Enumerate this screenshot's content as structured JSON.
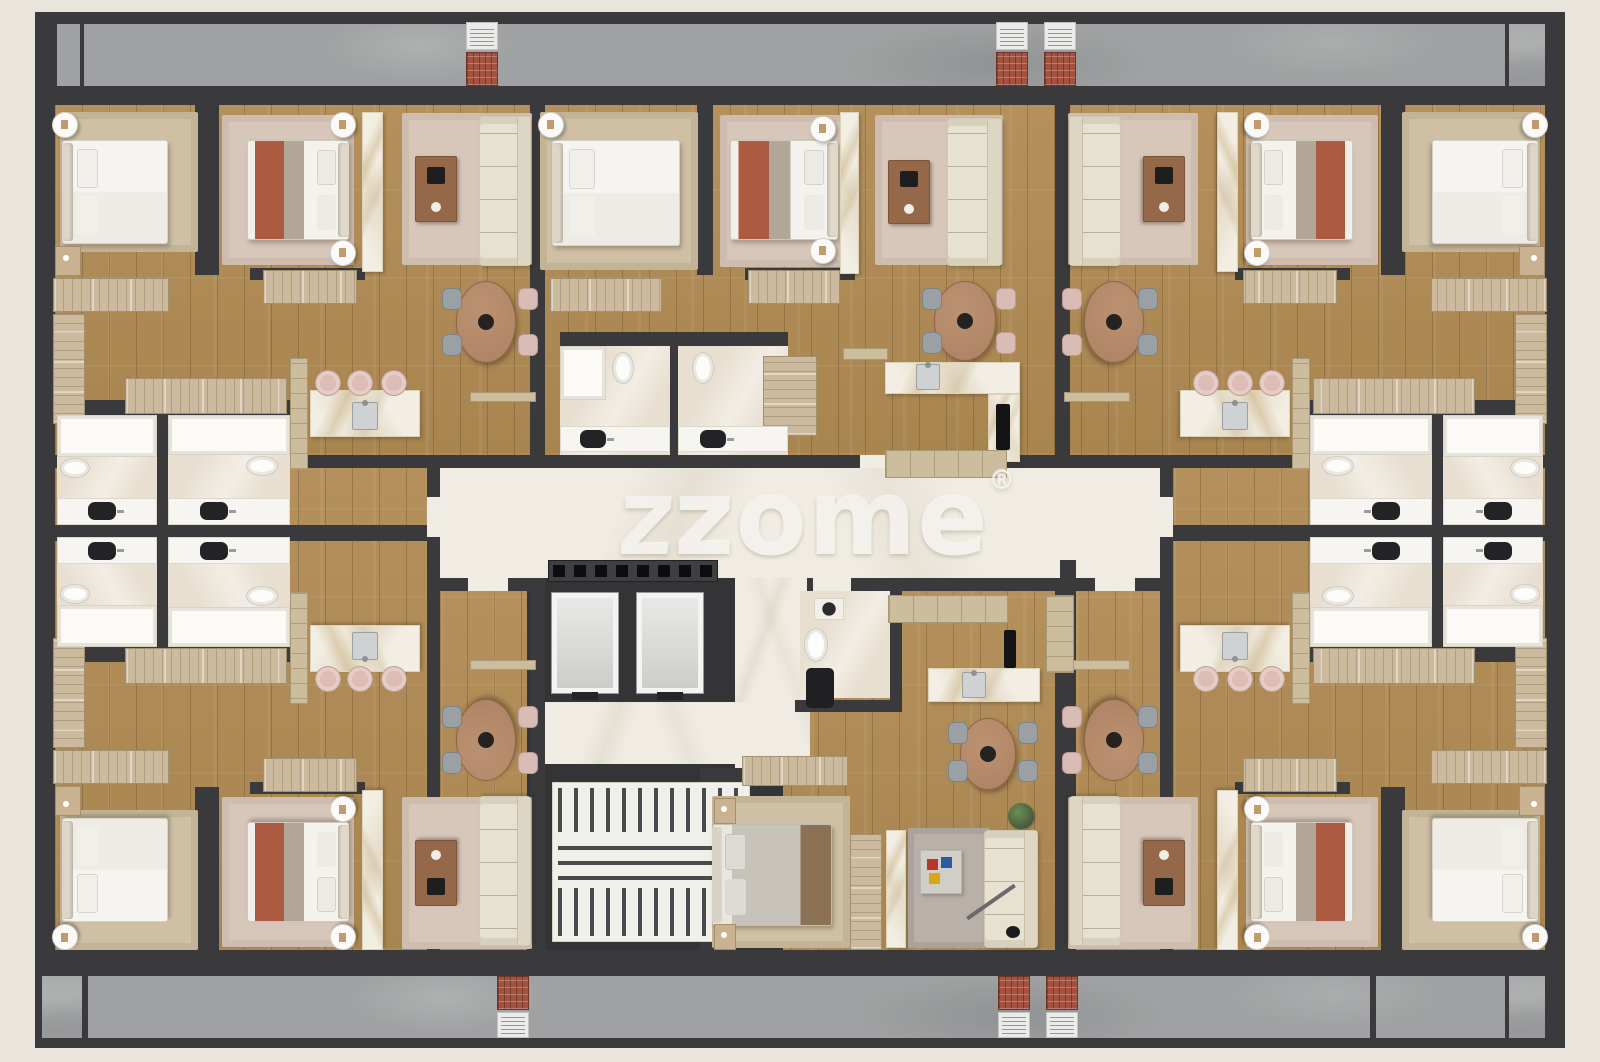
{
  "canvas": {
    "w": 1600,
    "h": 1062,
    "background": "#e9e5dd"
  },
  "watermark": {
    "logo_glyph": "z",
    "text": "zome",
    "registered": "®"
  },
  "palette": {
    "wall": "#3a393b",
    "wood": "#b08c58",
    "corridor_marble": "#f0ece3",
    "balcony_concrete": "#9fa1a2",
    "bathroom": "#e8dfd0",
    "accent_red_bed": "#ac5a42",
    "cabinet_tan": "#cbba9e",
    "sofa_cream": "#e7e1d1",
    "brick_bbq": "#a3523f",
    "watermark_color": "#f4f2ed"
  },
  "geometry": {
    "floors": [
      {
        "t": "base",
        "x": 35,
        "y": 12,
        "w": 1530,
        "h": 1036
      },
      {
        "t": "wood",
        "x": 55,
        "y": 105,
        "w": 1490,
        "h": 350
      },
      {
        "t": "wood",
        "x": 55,
        "y": 468,
        "w": 372,
        "h": 482
      },
      {
        "t": "wood",
        "x": 1173,
        "y": 468,
        "w": 372,
        "h": 482
      },
      {
        "t": "wood",
        "x": 440,
        "y": 590,
        "w": 720,
        "h": 360
      },
      {
        "t": "core",
        "x": 527,
        "y": 558,
        "w": 256,
        "h": 392
      },
      {
        "t": "marble",
        "x": 440,
        "y": 468,
        "w": 720,
        "h": 110
      },
      {
        "t": "marble",
        "x": 735,
        "y": 578,
        "w": 75,
        "h": 192
      },
      {
        "t": "marble",
        "x": 540,
        "y": 702,
        "w": 218,
        "h": 62
      },
      {
        "t": "bath",
        "x": 57,
        "y": 415,
        "w": 100,
        "h": 110,
        "m": "xy"
      },
      {
        "t": "bath",
        "x": 168,
        "y": 415,
        "w": 122,
        "h": 110,
        "m": "xy"
      },
      {
        "t": "bath",
        "x": 560,
        "y": 346,
        "w": 110,
        "h": 109
      },
      {
        "t": "bath",
        "x": 678,
        "y": 346,
        "w": 110,
        "h": 109
      },
      {
        "t": "bath",
        "x": 800,
        "y": 591,
        "w": 90,
        "h": 107
      },
      {
        "t": "concrete",
        "x": 57,
        "y": 24,
        "w": 1448,
        "h": 62
      },
      {
        "t": "concrete",
        "x": 1509,
        "y": 24,
        "w": 36,
        "h": 62
      },
      {
        "t": "concrete",
        "x": 88,
        "y": 976,
        "w": 1417,
        "h": 62
      },
      {
        "t": "concrete",
        "x": 42,
        "y": 976,
        "w": 40,
        "h": 62
      },
      {
        "t": "concrete",
        "x": 1509,
        "y": 976,
        "w": 36,
        "h": 62
      }
    ],
    "walls": [
      {
        "x": 195,
        "y": 105,
        "w": 24,
        "h": 170,
        "m": "xy"
      },
      {
        "x": 250,
        "y": 268,
        "w": 115,
        "h": 12,
        "m": "xy"
      },
      {
        "x": 157,
        "y": 415,
        "w": 11,
        "h": 110,
        "m": "xy"
      },
      {
        "x": 45,
        "y": 400,
        "w": 245,
        "h": 15,
        "m": "xy"
      },
      {
        "x": 530,
        "y": 105,
        "w": 15,
        "h": 350,
        "m": "x"
      },
      {
        "x": 35,
        "y": 525,
        "w": 405,
        "h": 16,
        "m": "x"
      },
      {
        "x": 427,
        "y": 455,
        "w": 13,
        "h": 136,
        "m": "x"
      },
      {
        "x": 427,
        "y": 578,
        "w": 113,
        "h": 13,
        "m": "x"
      },
      {
        "x": 530,
        "y": 578,
        "w": 15,
        "h": 372,
        "m": "x"
      },
      {
        "x": 427,
        "y": 455,
        "w": 746,
        "h": 13
      },
      {
        "x": 807,
        "y": 578,
        "w": 366,
        "h": 13
      },
      {
        "x": 697,
        "y": 105,
        "w": 16,
        "h": 170
      },
      {
        "x": 745,
        "y": 268,
        "w": 110,
        "h": 12
      },
      {
        "x": 560,
        "y": 332,
        "w": 228,
        "h": 14
      },
      {
        "x": 670,
        "y": 346,
        "w": 8,
        "h": 109
      },
      {
        "x": 1060,
        "y": 560,
        "w": 16,
        "h": 390
      },
      {
        "x": 890,
        "y": 585,
        "w": 12,
        "h": 118
      },
      {
        "x": 795,
        "y": 700,
        "w": 107,
        "h": 12
      },
      {
        "x": 700,
        "y": 768,
        "w": 110,
        "h": 16
      },
      {
        "x": 700,
        "y": 782,
        "w": 14,
        "h": 178
      },
      {
        "x": 80,
        "y": 24,
        "w": 4,
        "h": 62
      },
      {
        "x": 1370,
        "y": 976,
        "w": 6,
        "h": 62
      }
    ],
    "doors": [
      {
        "x": 468,
        "y": 578,
        "w": 40,
        "h": 13
      },
      {
        "x": 1095,
        "y": 578,
        "w": 40,
        "h": 13
      },
      {
        "x": 860,
        "y": 455,
        "w": 40,
        "h": 13
      },
      {
        "x": 427,
        "y": 497,
        "w": 13,
        "h": 40
      },
      {
        "x": 1160,
        "y": 497,
        "w": 13,
        "h": 40
      },
      {
        "x": 813,
        "y": 578,
        "w": 38,
        "h": 13
      }
    ]
  },
  "furniture": {
    "quadrant": [
      {
        "t": "rug-beige",
        "x": 60,
        "y": 112,
        "w": 138,
        "h": 140
      },
      {
        "t": "bed-white",
        "x": 62,
        "y": 140,
        "w": 106,
        "h": 104
      },
      {
        "t": "side-table",
        "x": 52,
        "y": 112,
        "w": 26,
        "h": 26
      },
      {
        "t": "nightstand",
        "x": 55,
        "y": 246,
        "w": 26,
        "h": 30
      },
      {
        "t": "rug-pink",
        "x": 222,
        "y": 115,
        "w": 132,
        "h": 150
      },
      {
        "t": "bed-red",
        "x": 247,
        "y": 140,
        "w": 102,
        "h": 100
      },
      {
        "t": "side-table",
        "x": 330,
        "y": 112,
        "w": 26,
        "h": 26
      },
      {
        "t": "side-table",
        "x": 330,
        "y": 240,
        "w": 26,
        "h": 26
      },
      {
        "t": "marble-strip",
        "x": 362,
        "y": 112,
        "w": 21,
        "h": 160
      },
      {
        "t": "rug-pink",
        "x": 402,
        "y": 113,
        "w": 130,
        "h": 152
      },
      {
        "t": "sofa",
        "x": 479,
        "y": 116,
        "w": 52,
        "h": 150
      },
      {
        "t": "coffee-table",
        "x": 415,
        "y": 156,
        "w": 42,
        "h": 66
      },
      {
        "t": "dining-table",
        "x": 456,
        "y": 281,
        "w": 60,
        "h": 82
      },
      {
        "t": "chair-gray",
        "x": 442,
        "y": 288,
        "w": 20,
        "h": 22
      },
      {
        "t": "chair-gray",
        "x": 442,
        "y": 334,
        "w": 20,
        "h": 22
      },
      {
        "t": "chair-pink",
        "x": 518,
        "y": 288,
        "w": 20,
        "h": 22
      },
      {
        "t": "chair-pink",
        "x": 518,
        "y": 334,
        "w": 20,
        "h": 22
      },
      {
        "t": "wardrobe",
        "x": 53,
        "y": 278,
        "w": 116,
        "h": 34
      },
      {
        "t": "wardrobe-v",
        "x": 53,
        "y": 314,
        "w": 32,
        "h": 110
      },
      {
        "t": "wardrobe",
        "x": 125,
        "y": 378,
        "w": 162,
        "h": 36
      },
      {
        "t": "wardrobe",
        "x": 263,
        "y": 270,
        "w": 94,
        "h": 34
      },
      {
        "t": "cab-tan-v",
        "x": 290,
        "y": 358,
        "w": 18,
        "h": 112
      },
      {
        "t": "island",
        "x": 310,
        "y": 390,
        "w": 110,
        "h": 47
      },
      {
        "t": "sink",
        "x": 352,
        "y": 402,
        "w": 26,
        "h": 28
      },
      {
        "t": "stool",
        "x": 315,
        "y": 370,
        "w": 26,
        "h": 26
      },
      {
        "t": "stool",
        "x": 347,
        "y": 370,
        "w": 26,
        "h": 26
      },
      {
        "t": "stool",
        "x": 381,
        "y": 370,
        "w": 26,
        "h": 26
      },
      {
        "t": "shelf-tan",
        "x": 470,
        "y": 392,
        "w": 66,
        "h": 10
      },
      {
        "t": "shower",
        "x": 57,
        "y": 415,
        "w": 100,
        "h": 42
      },
      {
        "t": "shower",
        "x": 168,
        "y": 415,
        "w": 122,
        "h": 40
      },
      {
        "t": "counter",
        "x": 57,
        "y": 498,
        "w": 100,
        "h": 27
      },
      {
        "t": "basin",
        "x": 88,
        "y": 502,
        "w": 28,
        "h": 18
      },
      {
        "t": "counter",
        "x": 168,
        "y": 498,
        "w": 122,
        "h": 27
      },
      {
        "t": "basin",
        "x": 200,
        "y": 502,
        "w": 28,
        "h": 18
      },
      {
        "t": "toilet",
        "x": 60,
        "y": 458,
        "w": 30,
        "h": 20
      },
      {
        "t": "toilet",
        "x": 246,
        "y": 456,
        "w": 32,
        "h": 20
      }
    ],
    "center_top": [
      {
        "t": "rug-beige",
        "x": 540,
        "y": 112,
        "w": 158,
        "h": 158
      },
      {
        "t": "bed-white",
        "x": 552,
        "y": 140,
        "w": 128,
        "h": 106
      },
      {
        "t": "side-table",
        "x": 538,
        "y": 112,
        "w": 26,
        "h": 26
      },
      {
        "t": "rug-pink",
        "x": 720,
        "y": 115,
        "w": 132,
        "h": 152
      },
      {
        "t": "bed-red",
        "x": 730,
        "y": 140,
        "w": 108,
        "h": 100
      },
      {
        "t": "side-table",
        "x": 810,
        "y": 116,
        "w": 26,
        "h": 26
      },
      {
        "t": "side-table",
        "x": 810,
        "y": 238,
        "w": 26,
        "h": 26
      },
      {
        "t": "marble-strip",
        "x": 840,
        "y": 112,
        "w": 19,
        "h": 162
      },
      {
        "t": "rug-pink",
        "x": 875,
        "y": 115,
        "w": 128,
        "h": 150
      },
      {
        "t": "sofa",
        "x": 947,
        "y": 118,
        "w": 55,
        "h": 148
      },
      {
        "t": "coffee-table",
        "x": 888,
        "y": 160,
        "w": 42,
        "h": 64
      },
      {
        "t": "wardrobe",
        "x": 550,
        "y": 278,
        "w": 112,
        "h": 34
      },
      {
        "t": "wardrobe",
        "x": 748,
        "y": 270,
        "w": 92,
        "h": 34
      },
      {
        "t": "wardrobe-v",
        "x": 763,
        "y": 356,
        "w": 54,
        "h": 80
      },
      {
        "t": "shelf-tan",
        "x": 843,
        "y": 348,
        "w": 45,
        "h": 12
      },
      {
        "t": "dining-table",
        "x": 934,
        "y": 281,
        "w": 62,
        "h": 80
      },
      {
        "t": "chair-gray",
        "x": 922,
        "y": 288,
        "w": 20,
        "h": 22
      },
      {
        "t": "chair-gray",
        "x": 922,
        "y": 332,
        "w": 20,
        "h": 22
      },
      {
        "t": "chair-pink",
        "x": 996,
        "y": 288,
        "w": 20,
        "h": 22
      },
      {
        "t": "chair-pink",
        "x": 996,
        "y": 332,
        "w": 20,
        "h": 22
      },
      {
        "t": "island",
        "x": 885,
        "y": 362,
        "w": 135,
        "h": 32
      },
      {
        "t": "sink",
        "x": 916,
        "y": 364,
        "w": 24,
        "h": 26
      },
      {
        "t": "island",
        "x": 988,
        "y": 394,
        "w": 32,
        "h": 68
      },
      {
        "t": "cooktop",
        "x": 996,
        "y": 404,
        "w": 14,
        "h": 46
      },
      {
        "t": "cab-tan",
        "x": 885,
        "y": 450,
        "w": 122,
        "h": 28
      },
      {
        "t": "shower",
        "x": 560,
        "y": 346,
        "w": 46,
        "h": 54
      },
      {
        "t": "toilet-v",
        "x": 612,
        "y": 352,
        "w": 22,
        "h": 32
      },
      {
        "t": "toilet-v",
        "x": 692,
        "y": 352,
        "w": 22,
        "h": 32
      },
      {
        "t": "counter",
        "x": 560,
        "y": 426,
        "w": 110,
        "h": 26
      },
      {
        "t": "basin",
        "x": 580,
        "y": 430,
        "w": 26,
        "h": 18
      },
      {
        "t": "counter",
        "x": 678,
        "y": 426,
        "w": 110,
        "h": 26
      },
      {
        "t": "basin",
        "x": 700,
        "y": 430,
        "w": 26,
        "h": 18
      }
    ],
    "core": [
      {
        "t": "shoe-cab",
        "x": 548,
        "y": 560,
        "w": 170,
        "h": 22
      },
      {
        "t": "elevator",
        "x": 552,
        "y": 593,
        "w": 66,
        "h": 100
      },
      {
        "t": "elevator",
        "x": 637,
        "y": 593,
        "w": 66,
        "h": 100
      },
      {
        "t": "stairs-floor",
        "x": 552,
        "y": 782,
        "w": 198,
        "h": 160
      },
      {
        "t": "steps-v",
        "x": 558,
        "y": 788,
        "w": 186,
        "h": 44
      },
      {
        "t": "steps-h",
        "x": 558,
        "y": 840,
        "w": 186,
        "h": 40
      },
      {
        "t": "steps-v",
        "x": 558,
        "y": 888,
        "w": 186,
        "h": 48
      }
    ],
    "center_bottom": [
      {
        "t": "washbasin",
        "x": 814,
        "y": 598,
        "w": 30,
        "h": 22
      },
      {
        "t": "toilet-v",
        "x": 804,
        "y": 628,
        "w": 24,
        "h": 34
      },
      {
        "t": "bench",
        "x": 806,
        "y": 668,
        "w": 28,
        "h": 40
      },
      {
        "t": "cab-tan",
        "x": 888,
        "y": 595,
        "w": 120,
        "h": 28
      },
      {
        "t": "cab-tan-v",
        "x": 1046,
        "y": 595,
        "w": 28,
        "h": 78
      },
      {
        "t": "cooktop",
        "x": 1004,
        "y": 630,
        "w": 12,
        "h": 38
      },
      {
        "t": "island",
        "x": 928,
        "y": 668,
        "w": 112,
        "h": 34
      },
      {
        "t": "sink",
        "x": 962,
        "y": 672,
        "w": 24,
        "h": 26
      },
      {
        "t": "dining-table",
        "x": 960,
        "y": 718,
        "w": 56,
        "h": 72
      },
      {
        "t": "chair-gray",
        "x": 948,
        "y": 722,
        "w": 20,
        "h": 22
      },
      {
        "t": "chair-gray",
        "x": 948,
        "y": 760,
        "w": 20,
        "h": 22
      },
      {
        "t": "chair-gray",
        "x": 1018,
        "y": 722,
        "w": 20,
        "h": 22
      },
      {
        "t": "chair-gray",
        "x": 1018,
        "y": 760,
        "w": 20,
        "h": 22
      },
      {
        "t": "plant",
        "x": 1008,
        "y": 803,
        "w": 26,
        "h": 26
      },
      {
        "t": "rug-beige",
        "x": 712,
        "y": 796,
        "w": 138,
        "h": 152
      },
      {
        "t": "bed-gray",
        "x": 712,
        "y": 824,
        "w": 120,
        "h": 102
      },
      {
        "t": "nightstand",
        "x": 714,
        "y": 798,
        "w": 22,
        "h": 26
      },
      {
        "t": "nightstand",
        "x": 714,
        "y": 924,
        "w": 22,
        "h": 26
      },
      {
        "t": "wardrobe",
        "x": 742,
        "y": 756,
        "w": 106,
        "h": 30
      },
      {
        "t": "wardrobe-v",
        "x": 850,
        "y": 834,
        "w": 32,
        "h": 116
      },
      {
        "t": "marble-strip",
        "x": 886,
        "y": 830,
        "w": 20,
        "h": 118
      },
      {
        "t": "rug-gray",
        "x": 908,
        "y": 828,
        "w": 82,
        "h": 120
      },
      {
        "t": "sofa",
        "x": 984,
        "y": 830,
        "w": 54,
        "h": 118
      },
      {
        "t": "coffee-glass",
        "x": 920,
        "y": 850,
        "w": 42,
        "h": 44
      },
      {
        "t": "lamp",
        "x": 962,
        "y": 900,
        "w": 58,
        "h": 4,
        "r": -35
      },
      {
        "t": "lamp-head",
        "x": 1006,
        "y": 926,
        "w": 14,
        "h": 12
      }
    ],
    "balcony": [
      {
        "t": "grill",
        "x": 466,
        "y": 22,
        "w": 32,
        "h": 28
      },
      {
        "t": "brick",
        "x": 466,
        "y": 52,
        "w": 32,
        "h": 34
      },
      {
        "t": "grill",
        "x": 996,
        "y": 22,
        "w": 32,
        "h": 28
      },
      {
        "t": "brick",
        "x": 996,
        "y": 52,
        "w": 32,
        "h": 34
      },
      {
        "t": "grill",
        "x": 1044,
        "y": 22,
        "w": 32,
        "h": 28
      },
      {
        "t": "brick",
        "x": 1044,
        "y": 52,
        "w": 32,
        "h": 34
      },
      {
        "t": "brick",
        "x": 497,
        "y": 976,
        "w": 32,
        "h": 34
      },
      {
        "t": "grill",
        "x": 497,
        "y": 1012,
        "w": 32,
        "h": 26
      },
      {
        "t": "brick",
        "x": 998,
        "y": 976,
        "w": 32,
        "h": 34
      },
      {
        "t": "grill",
        "x": 998,
        "y": 1012,
        "w": 32,
        "h": 26
      },
      {
        "t": "brick",
        "x": 1046,
        "y": 976,
        "w": 32,
        "h": 34
      },
      {
        "t": "grill",
        "x": 1046,
        "y": 1012,
        "w": 32,
        "h": 26
      }
    ]
  }
}
